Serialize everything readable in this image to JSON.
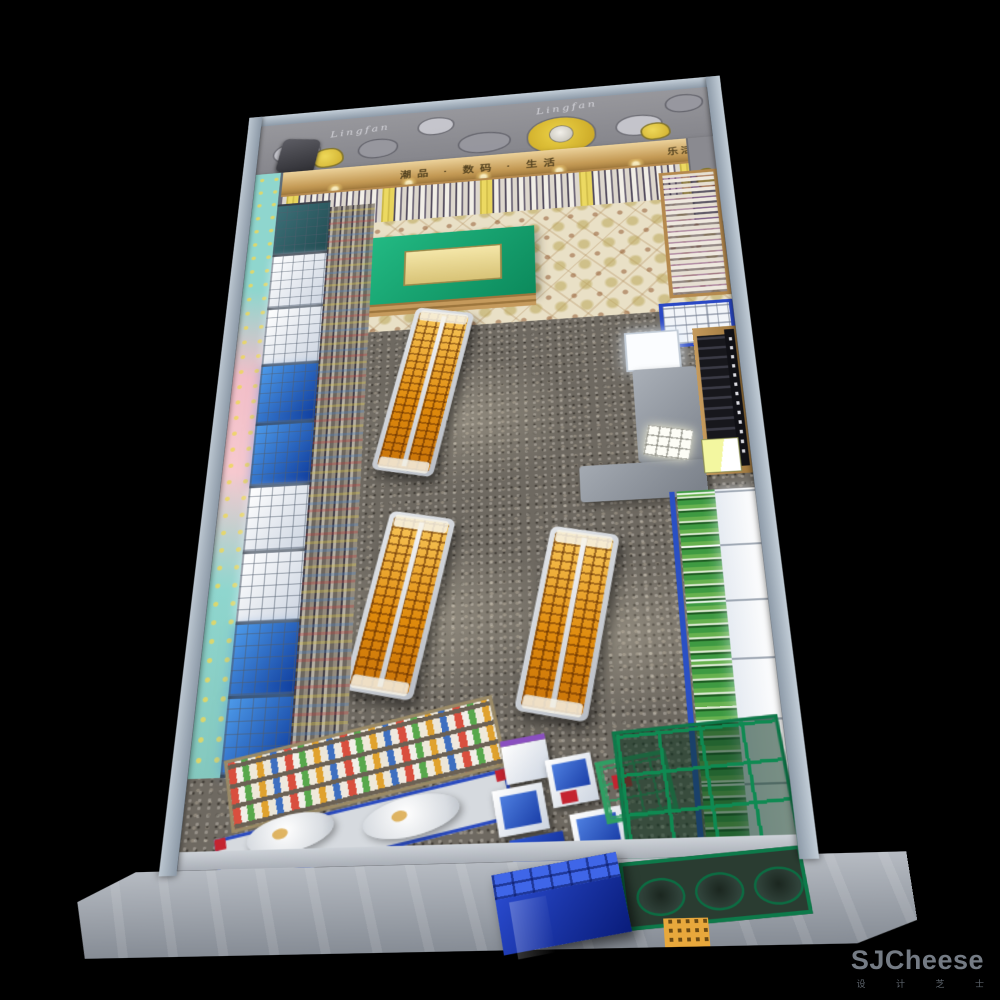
{
  "scene": {
    "description": "Bird's-eye 3D interior render of a retail / snack store floor plan on a black background",
    "background_color": "#000000"
  },
  "watermark": {
    "title": "SJCheese",
    "subtitle": "设 计 芝 士",
    "color": "#747b84"
  },
  "signs": {
    "header_text": "潮品 · 数码 · 生活",
    "header_right_text": "乐活",
    "header_panel_color": "#c9a76a",
    "header_text_color": "#53421f",
    "mural_script": "Lingfan"
  },
  "palette": {
    "wall": "#9fadbb",
    "top_mural_gray": "#8f8f95",
    "mural_accent_yellow": "#e4cb3f",
    "left_mural_teal": "#8fd6ce",
    "left_mural_pink": "#f2bec8",
    "wood": "#c09356",
    "tile_floor": "#e9e0c6",
    "terrazzo_floor": "#6e6961",
    "gondola_product_orange": "#e8920f",
    "canopy_white": "#f4f7fc",
    "canopy_blue": "#2f7bd6",
    "table_green": "#14a473",
    "cooler_product_green": "#3e9a42",
    "entrance_grid_green": "#0f8a52",
    "cabinet_blue": "#16309c",
    "accent_red": "#c42430",
    "apron_gray": "#a9afb8"
  },
  "fixtures": [
    {
      "name": "top-wall-shelving",
      "label": "back wall shelving stocked with white and yellow boxes"
    },
    {
      "name": "green-display-table",
      "label": "green promo table with gold tray on patterned tiles"
    },
    {
      "name": "center-gondolas",
      "label": "three gondola runs fully stocked with orange products",
      "count": 3
    },
    {
      "name": "left-wall-bays",
      "label": "illuminated wall bays with alternating white and blue canopies"
    },
    {
      "name": "cashier-counter",
      "label": "gray L-shaped counter with lit white display case"
    },
    {
      "name": "slat-cabinet",
      "label": "wood cabinet with black slat shelving and vertical black sign"
    },
    {
      "name": "right-cooler-run",
      "label": "drink cooler run with white lit canopy and green products"
    },
    {
      "name": "checkout-candy-racks",
      "label": "tiered multicolor candy racks with blue-framed front counters"
    },
    {
      "name": "entrance-kiosks",
      "label": "small illuminated kiosks (white / blue / red panels)"
    },
    {
      "name": "blue-cabinet",
      "label": "glossy dark-blue cabinet at storefront"
    },
    {
      "name": "entrance-green-grid",
      "label": "green framed glass floor grid with round cutouts at entrance"
    }
  ]
}
